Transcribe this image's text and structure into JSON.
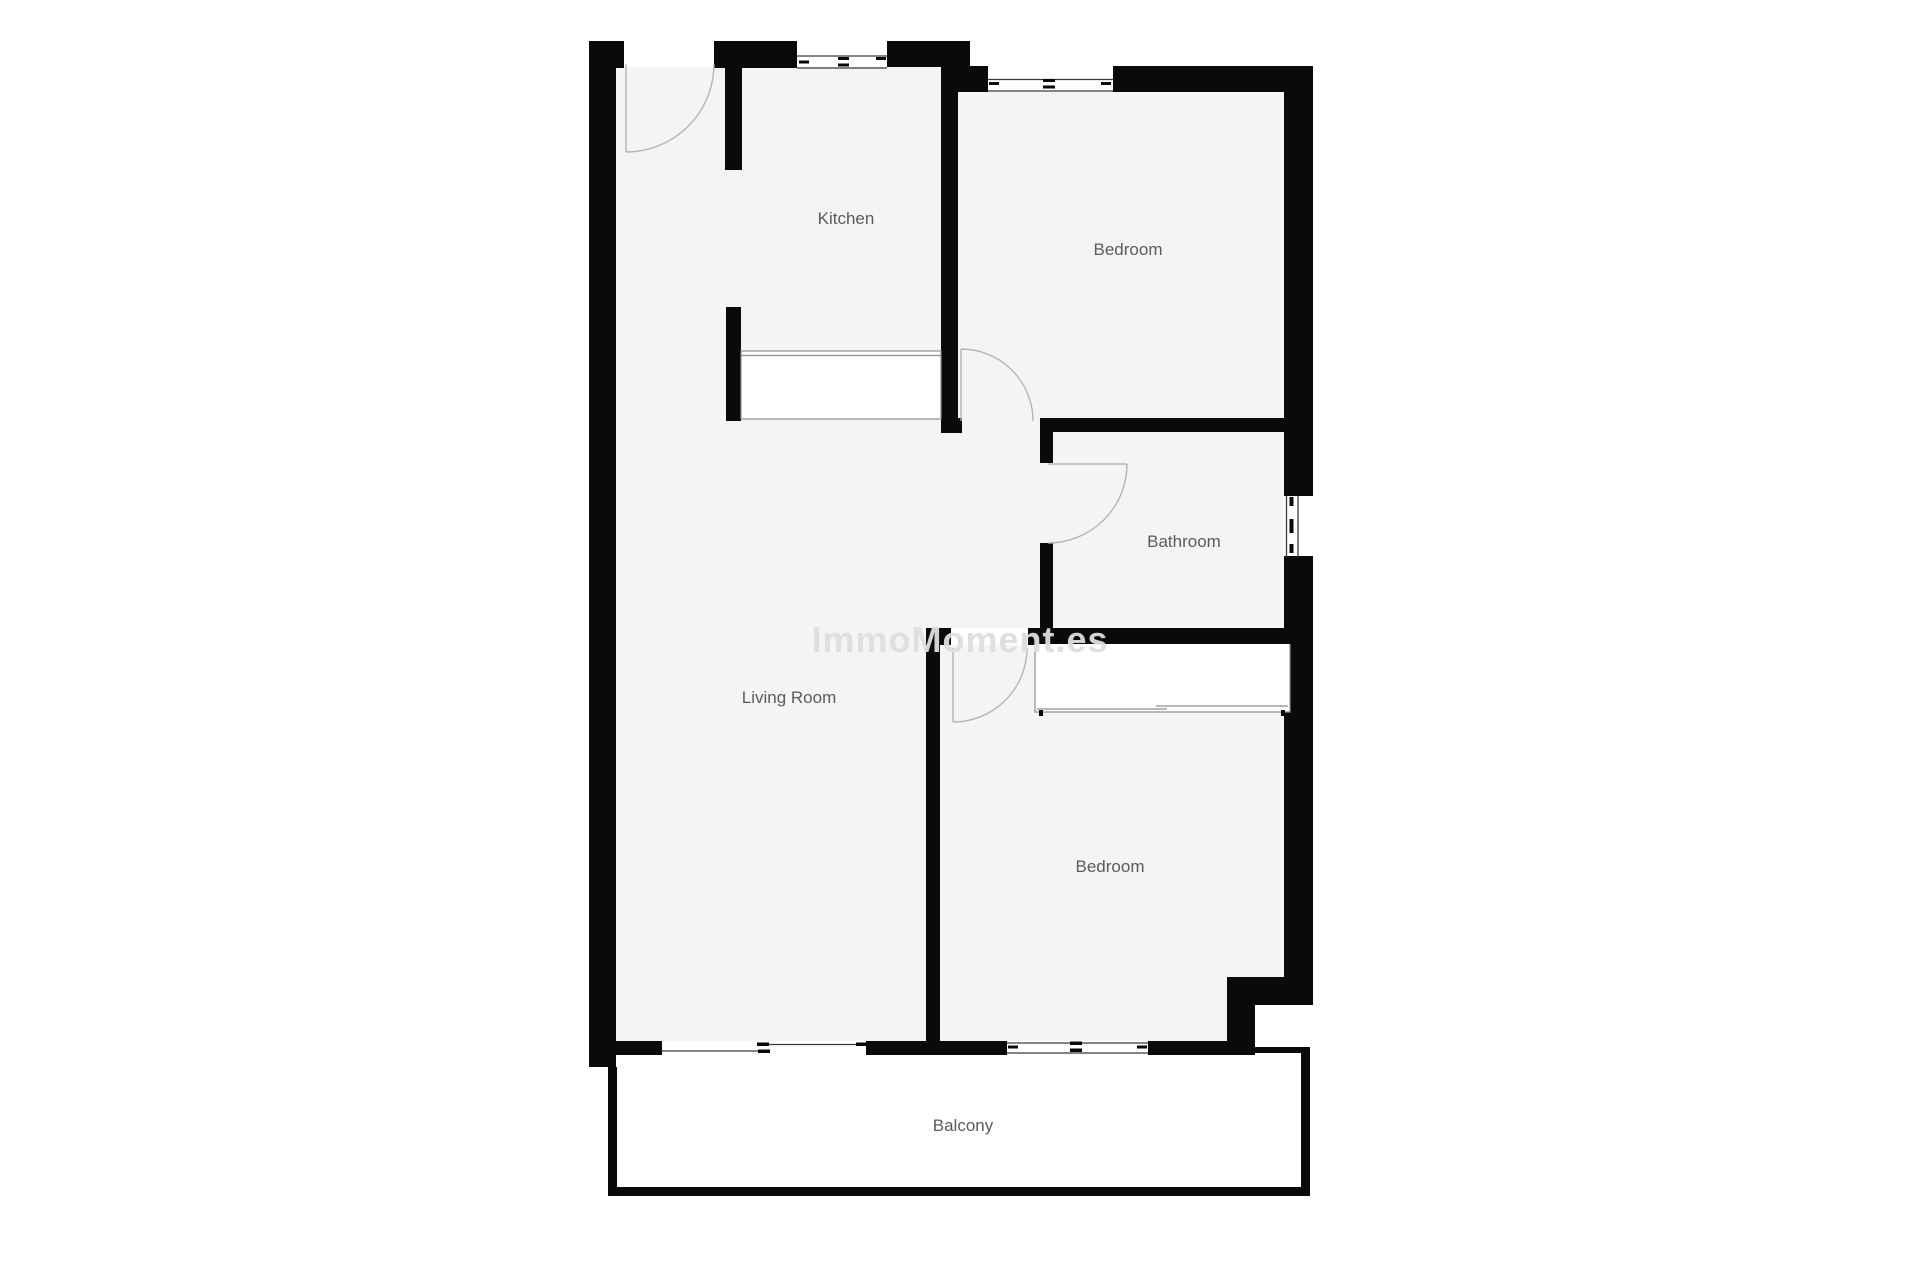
{
  "watermark": {
    "text": "ImmoMoment.es"
  },
  "rooms": {
    "kitchen": {
      "label": "Kitchen"
    },
    "bedroom1": {
      "label": "Bedroom"
    },
    "bathroom": {
      "label": "Bathroom"
    },
    "living_room": {
      "label": "Living Room"
    },
    "bedroom2": {
      "label": "Bedroom"
    },
    "balcony": {
      "label": "Balcony"
    }
  },
  "colors": {
    "wall": "#0a0a0a",
    "room_fill": "#f4f4f4",
    "label": "#585c60",
    "door_arc": "#b5b5b5",
    "window_line": "#3a3a3a",
    "fixture_line": "#8f8f8f",
    "watermark": "#dedede"
  }
}
